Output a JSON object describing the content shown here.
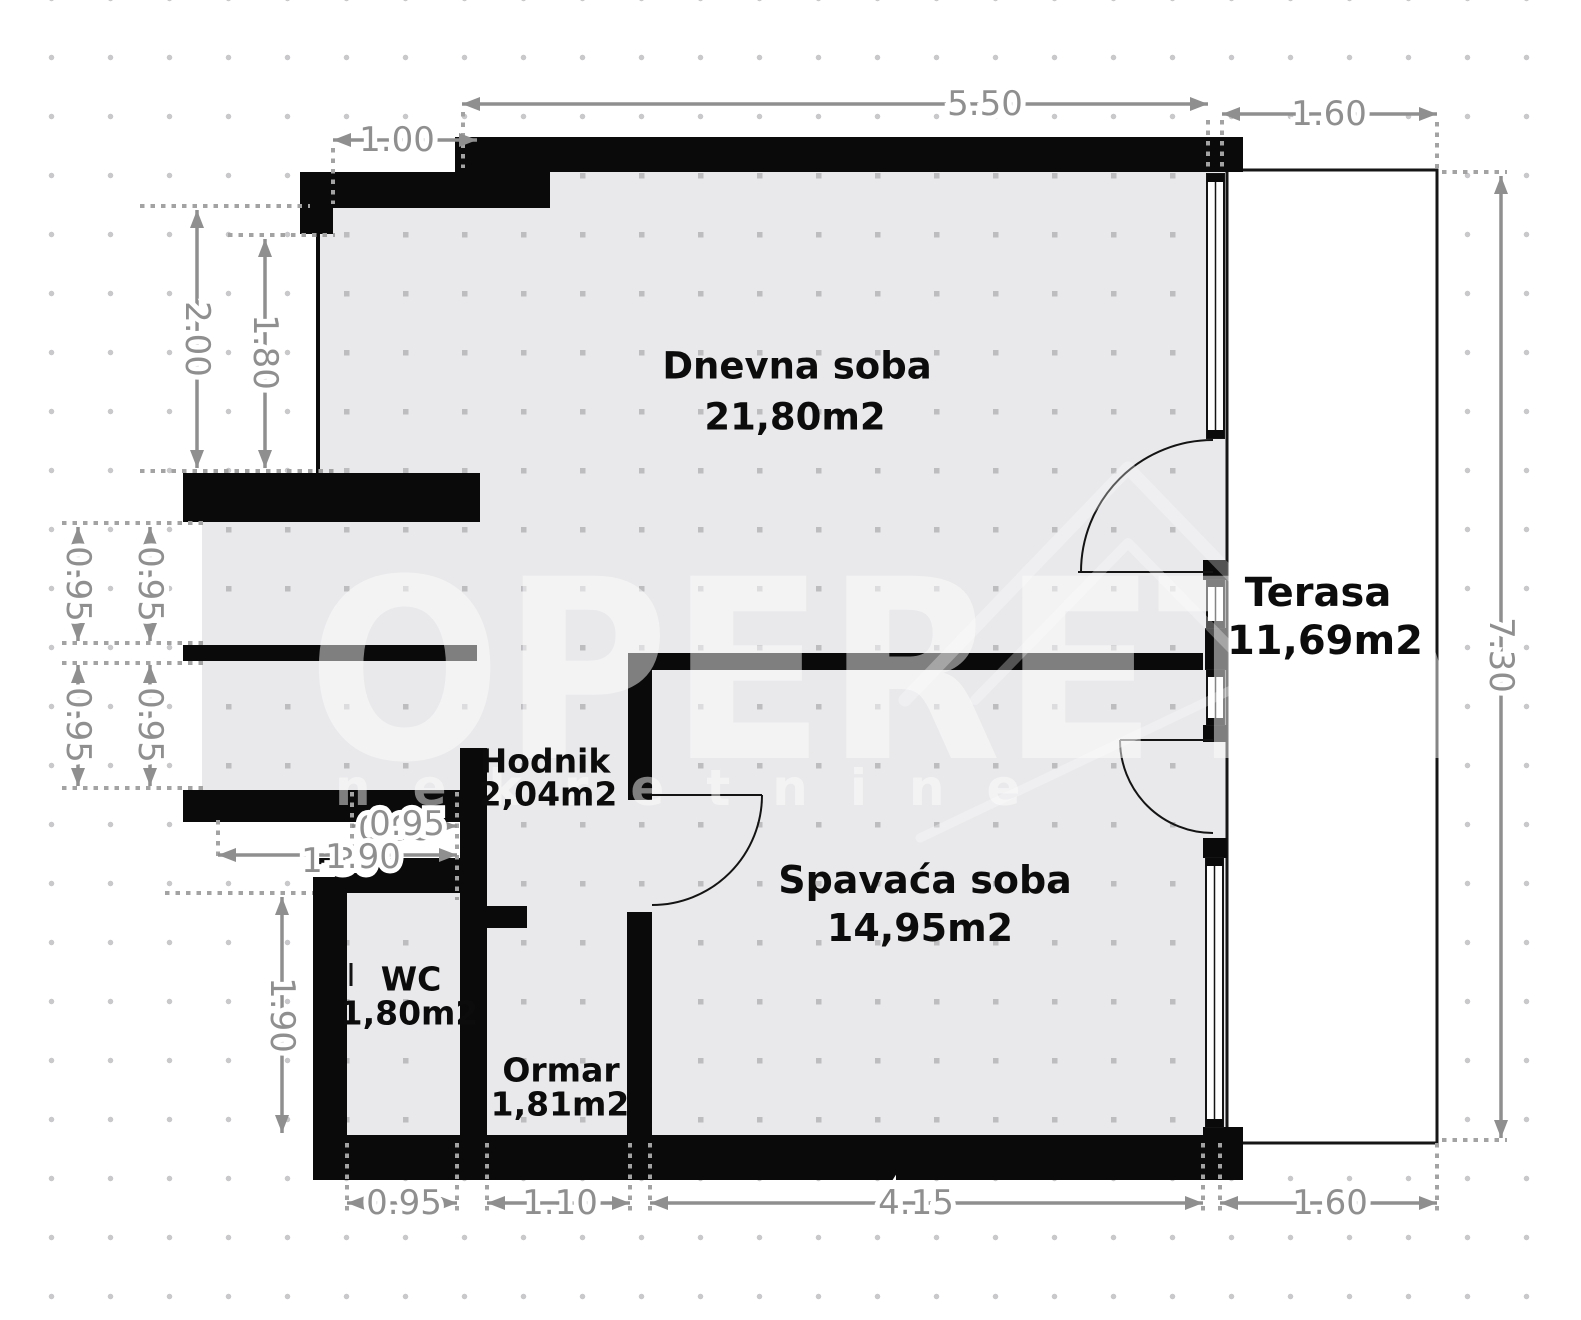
{
  "watermark": {
    "brand": "OPERETA",
    "sub": "nekretnine"
  },
  "rooms": {
    "living": {
      "name": "Dnevna soba",
      "area": "21,80m2"
    },
    "terrace": {
      "name": "Terasa",
      "area": "11,69m2"
    },
    "hall": {
      "name": "Hodnik",
      "area": "2,04m2"
    },
    "bedroom": {
      "name": "Spavaća soba",
      "area": "14,95m2"
    },
    "wc": {
      "name": "WC",
      "area": "1,80m2"
    },
    "closet": {
      "name": "Ormar",
      "area": "1,81m2"
    }
  },
  "dims": {
    "top_550": "5.50",
    "top_160": "1.60",
    "top_100": "1.00",
    "left_200": "2.00",
    "left_180": "1.80",
    "left_095_outer_upper": "0.95",
    "left_095_inner_upper": "0.95",
    "left_095_outer_lower": "0.95",
    "left_095_inner_lower": "0.95",
    "left_190_wc": "1.90",
    "entry_095": "0.95",
    "entry_095_ghost": "0.95",
    "entry_190": "1.90",
    "entry_130_ghost": "1.30",
    "right_730": "7.30",
    "bottom_095": "0.95",
    "bottom_110": "1.10",
    "bottom_415": "4.15",
    "bottom_160": "1.60"
  },
  "colors": {
    "wall": "#0a0a0a",
    "floor": "#e9e9eb",
    "dimension": "#8f8f8f",
    "background": "#ffffff"
  }
}
